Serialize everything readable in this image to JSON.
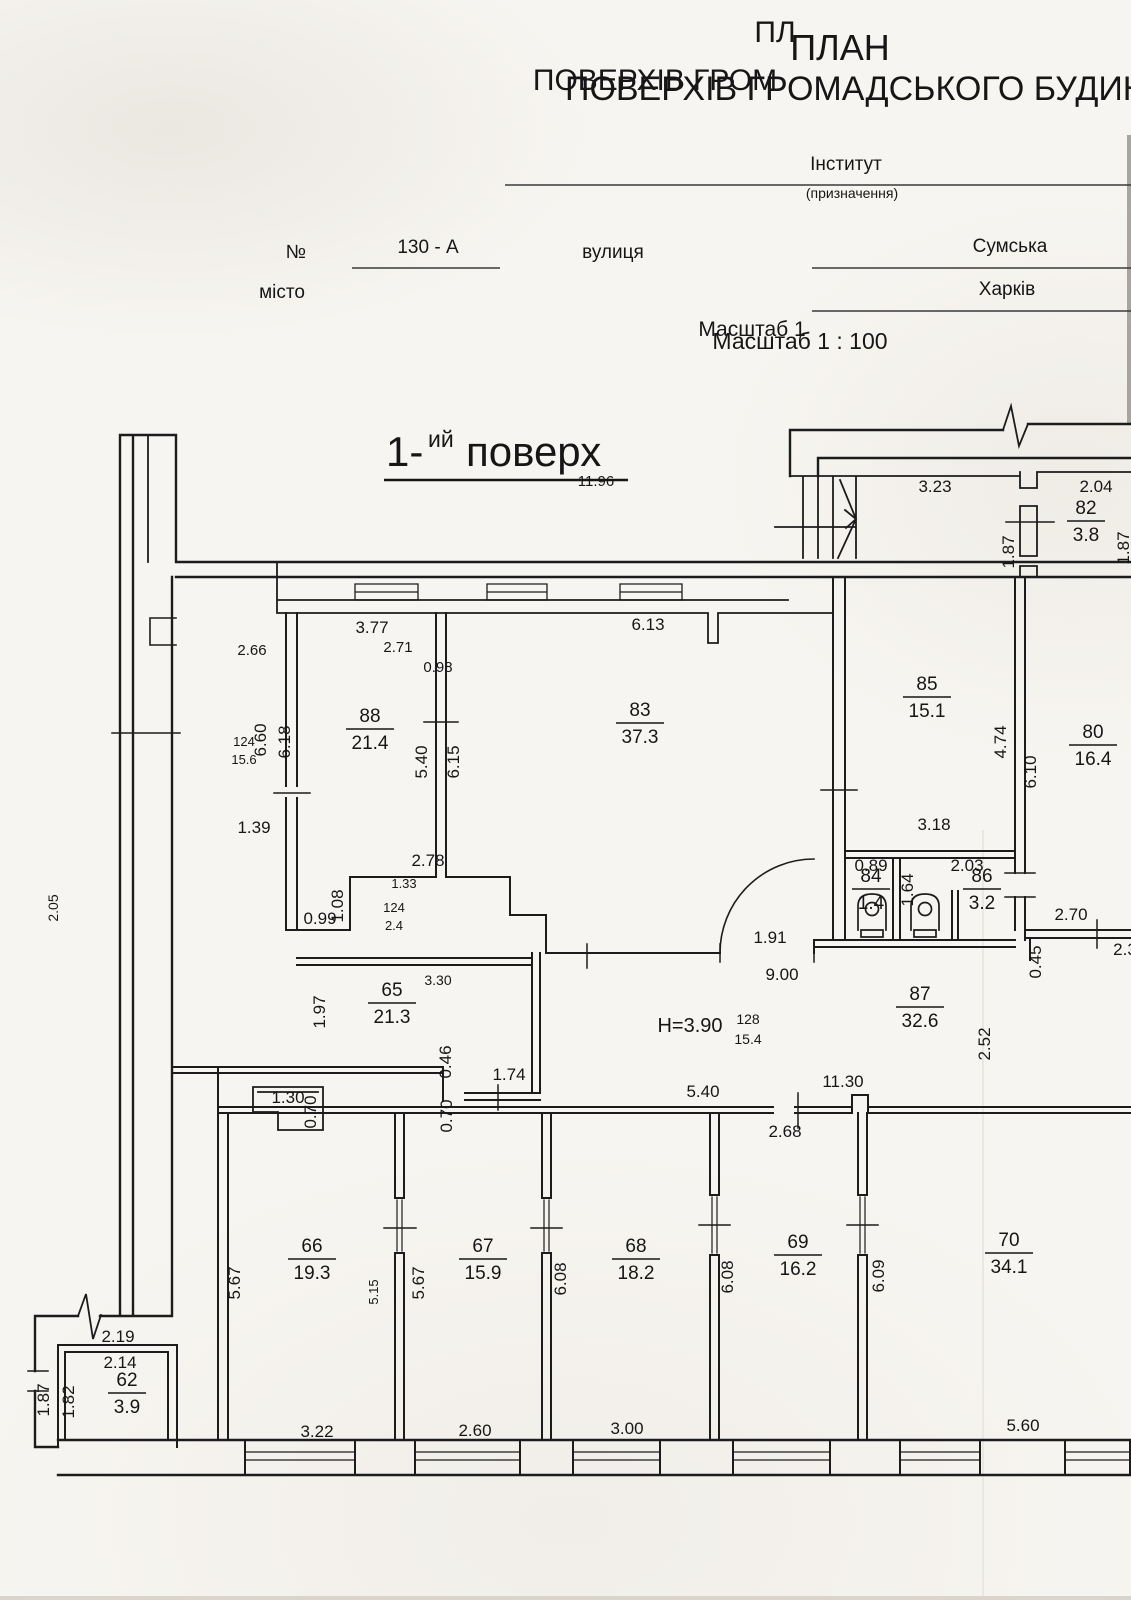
{
  "header": {
    "title1": "ПЛАН",
    "title2": "ПОВЕРХІВ ГРОМАДСЬКОГО БУДИНКУ",
    "institute": "Інститут",
    "purpose": "(призначення)",
    "num_label": "№",
    "num_value": "130 - А",
    "street_label": "вулиця",
    "street_value": "Сумська",
    "city_label": "місто",
    "city_value": "Харків",
    "scale": "Масштаб 1 : 100"
  },
  "floor": {
    "prefix": "1-",
    "sup": "ий",
    "word": "поверх"
  },
  "plan": {
    "rooms": [
      {
        "n": "88",
        "a": "21.4",
        "x": 370,
        "y": 722
      },
      {
        "n": "83",
        "a": "37.3",
        "x": 640,
        "y": 716
      },
      {
        "n": "85",
        "a": "15.1",
        "x": 927,
        "y": 690
      },
      {
        "n": "80",
        "a": "16.4",
        "x": 1093,
        "y": 738
      },
      {
        "n": "82",
        "a": "3.8",
        "x": 1086,
        "y": 514
      },
      {
        "n": "84",
        "a": "1.4",
        "x": 871,
        "y": 882
      },
      {
        "n": "86",
        "a": "3.2",
        "x": 982,
        "y": 882
      },
      {
        "n": "87",
        "a": "32.6",
        "x": 920,
        "y": 1000
      },
      {
        "n": "65",
        "a": "21.3",
        "x": 392,
        "y": 996
      },
      {
        "n": "66",
        "a": "19.3",
        "x": 312,
        "y": 1252
      },
      {
        "n": "67",
        "a": "15.9",
        "x": 483,
        "y": 1252
      },
      {
        "n": "68",
        "a": "18.2",
        "x": 636,
        "y": 1252
      },
      {
        "n": "69",
        "a": "16.2",
        "x": 798,
        "y": 1248
      },
      {
        "n": "70",
        "a": "34.1",
        "x": 1009,
        "y": 1246
      },
      {
        "n": "62",
        "a": "3.9",
        "x": 127,
        "y": 1386
      }
    ],
    "dims": [
      {
        "t": "3.77",
        "x": 372,
        "y": 633
      },
      {
        "t": "6.13",
        "x": 648,
        "y": 630
      },
      {
        "t": "3.23",
        "x": 935,
        "y": 492
      },
      {
        "t": "2.04",
        "x": 1096,
        "y": 492
      },
      {
        "t": "1.87",
        "x": 1014,
        "y": 552,
        "r": 1
      },
      {
        "t": "1.87",
        "x": 1129,
        "y": 548,
        "r": 1
      },
      {
        "t": "6.60",
        "x": 266,
        "y": 740,
        "r": 1
      },
      {
        "t": "6.18",
        "x": 290,
        "y": 742,
        "r": 1
      },
      {
        "t": "5.40",
        "x": 427,
        "y": 762,
        "r": 1
      },
      {
        "t": "6.15",
        "x": 459,
        "y": 762,
        "r": 1
      },
      {
        "t": "1.39",
        "x": 254,
        "y": 833
      },
      {
        "t": "4.74",
        "x": 1006,
        "y": 742,
        "r": 1
      },
      {
        "t": "6.10",
        "x": 1036,
        "y": 772,
        "r": 1
      },
      {
        "t": "2.78",
        "x": 428,
        "y": 866
      },
      {
        "t": "1.08",
        "x": 343,
        "y": 906,
        "r": 1
      },
      {
        "t": "0.99",
        "x": 320,
        "y": 924
      },
      {
        "t": "3.18",
        "x": 934,
        "y": 830
      },
      {
        "t": "0.89",
        "x": 871,
        "y": 871
      },
      {
        "t": "1.64",
        "x": 913,
        "y": 890,
        "r": 1
      },
      {
        "t": "2.03",
        "x": 967,
        "y": 871
      },
      {
        "t": "2.70",
        "x": 1071,
        "y": 920
      },
      {
        "t": "0.45",
        "x": 1041,
        "y": 962,
        "r": 1
      },
      {
        "t": "2.3",
        "x": 1125,
        "y": 955
      },
      {
        "t": "1.91",
        "x": 770,
        "y": 943
      },
      {
        "t": "9.00",
        "x": 782,
        "y": 980
      },
      {
        "t": "H=3.90",
        "x": 690,
        "y": 1032,
        "big": 1
      },
      {
        "t": "2.52",
        "x": 990,
        "y": 1044,
        "r": 1
      },
      {
        "t": "1.97",
        "x": 325,
        "y": 1012,
        "r": 1
      },
      {
        "t": "0.46",
        "x": 451,
        "y": 1062,
        "r": 1
      },
      {
        "t": "1.74",
        "x": 509,
        "y": 1080
      },
      {
        "t": "0.70",
        "x": 452,
        "y": 1116,
        "r": 1
      },
      {
        "t": "1.30",
        "x": 288,
        "y": 1103
      },
      {
        "t": "0.70",
        "x": 316,
        "y": 1112,
        "r": 1
      },
      {
        "t": "5.40",
        "x": 703,
        "y": 1097
      },
      {
        "t": "11.30",
        "x": 843,
        "y": 1087
      },
      {
        "t": "2.68",
        "x": 785,
        "y": 1137
      },
      {
        "t": "5.67",
        "x": 240,
        "y": 1283,
        "r": 1
      },
      {
        "t": "5.67",
        "x": 424,
        "y": 1283,
        "r": 1
      },
      {
        "t": "6.08",
        "x": 566,
        "y": 1279,
        "r": 1
      },
      {
        "t": "6.08",
        "x": 733,
        "y": 1277,
        "r": 1
      },
      {
        "t": "6.09",
        "x": 884,
        "y": 1276,
        "r": 1
      },
      {
        "t": "3.22",
        "x": 317,
        "y": 1437
      },
      {
        "t": "2.60",
        "x": 475,
        "y": 1436
      },
      {
        "t": "3.00",
        "x": 627,
        "y": 1434
      },
      {
        "t": "5.60",
        "x": 1023,
        "y": 1431
      },
      {
        "t": "2.19",
        "x": 118,
        "y": 1342
      },
      {
        "t": "2.14",
        "x": 120,
        "y": 1368
      },
      {
        "t": "1.87",
        "x": 49,
        "y": 1400,
        "r": 1
      },
      {
        "t": "1.82",
        "x": 74,
        "y": 1402,
        "r": 1
      }
    ],
    "ghosts": [
      {
        "t": "ПЛ",
        "x": 775,
        "y": 42,
        "s": 30
      },
      {
        "t": "ПОВЕРХІВ ГРОМ",
        "x": 655,
        "y": 90,
        "s": 30
      },
      {
        "t": "Масштаб 1",
        "x": 752,
        "y": 336,
        "s": 21
      },
      {
        "t": "11.96",
        "x": 596,
        "y": 486,
        "s": 15
      },
      {
        "t": "2.66",
        "x": 252,
        "y": 655,
        "s": 15
      },
      {
        "t": "2.71",
        "x": 398,
        "y": 652,
        "s": 15
      },
      {
        "t": "0.98",
        "x": 438,
        "y": 672,
        "s": 15
      },
      {
        "t": "124",
        "x": 244,
        "y": 746,
        "s": 13
      },
      {
        "t": "15.6",
        "x": 244,
        "y": 764,
        "s": 13
      },
      {
        "t": "1.33",
        "x": 404,
        "y": 888,
        "s": 13
      },
      {
        "t": "124",
        "x": 394,
        "y": 912,
        "s": 13
      },
      {
        "t": "2.4",
        "x": 394,
        "y": 930,
        "s": 13
      },
      {
        "t": "3.30",
        "x": 438,
        "y": 985,
        "s": 14
      },
      {
        "t": "128",
        "x": 748,
        "y": 1024,
        "s": 14
      },
      {
        "t": "15.4",
        "x": 748,
        "y": 1044,
        "s": 14
      },
      {
        "t": "2.05",
        "x": 58,
        "y": 908,
        "s": 14,
        "r": 1
      },
      {
        "t": "5.15",
        "x": 378,
        "y": 1292,
        "s": 13,
        "r": 1
      }
    ]
  }
}
